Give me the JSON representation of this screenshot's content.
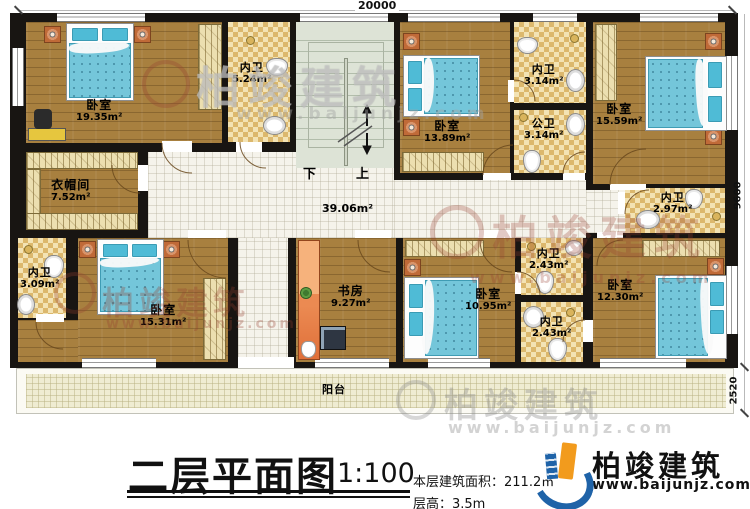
{
  "title_block": {
    "title": "二层平面图",
    "scale": "1:100",
    "area_line": "本层建筑面积：211.2㎡",
    "height_line": "层高：3.5m"
  },
  "brand": {
    "name": "柏竣建筑",
    "url": "www.baijunjz.com"
  },
  "watermark": {
    "name": "柏竣建筑",
    "url": "www.baijunjz.com"
  },
  "dimensions": {
    "top": "20000",
    "right": "9600",
    "balcony": "2520"
  },
  "stairs": {
    "down": "下",
    "up": "上"
  },
  "hall": {
    "area": "39.06m²"
  },
  "balcony": {
    "label": "阳台"
  },
  "rooms": [
    {
      "name": "卧室",
      "area": "19.35m²"
    },
    {
      "name": "内卫",
      "area": "5.24m²"
    },
    {
      "name": "卧室",
      "area": "13.89m²"
    },
    {
      "name": "内卫",
      "area": "3.14m²"
    },
    {
      "name": "公卫",
      "area": "3.14m²"
    },
    {
      "name": "卧室",
      "area": "15.59m²"
    },
    {
      "name": "内卫",
      "area": "2.97m²"
    },
    {
      "name": "衣帽间",
      "area": "7.52m²"
    },
    {
      "name": "内卫",
      "area": "3.09m²"
    },
    {
      "name": "卧室",
      "area": "15.31m²"
    },
    {
      "name": "书房",
      "area": "9.27m²"
    },
    {
      "name": "卧室",
      "area": "10.95m²"
    },
    {
      "name": "内卫",
      "area": "2.43m²"
    },
    {
      "name": "内卫",
      "area": "2.43m²"
    },
    {
      "name": "卧室",
      "area": "12.30m²"
    }
  ]
}
